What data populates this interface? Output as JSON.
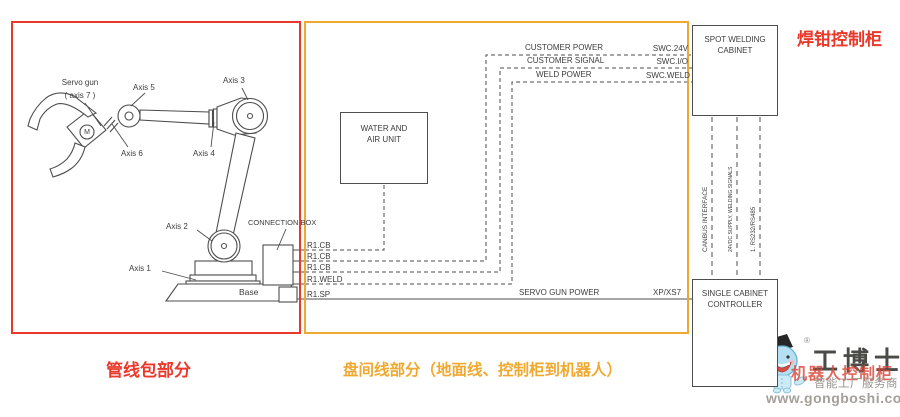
{
  "colors": {
    "region_red": "#e8392b",
    "region_orange": "#f0a930",
    "line_gray": "#4d4d4d",
    "text_gray": "#3c3c3c"
  },
  "regions": {
    "dress_pack_label": "管线包部分",
    "interconnect_label": "盘间线部分（地面线、控制柜到机器人）",
    "weld_cabinet_label": "焊钳控制柜"
  },
  "robot": {
    "servo_gun_line1": "Servo gun",
    "servo_gun_line2": "( axis 7 )",
    "axis1": "Axis 1",
    "axis2": "Axis 2",
    "axis3": "Axis 3",
    "axis4": "Axis 4",
    "axis5": "Axis 5",
    "axis6": "Axis 6",
    "motor": "M",
    "base": "Base",
    "connection_box": "CONNECTION BOX"
  },
  "units": {
    "water_air_line1": "WATER AND",
    "water_air_line2": "AIR UNIT",
    "spot_welding_line1": "SPOT WELDING",
    "spot_welding_line2": "CABINET",
    "controller_line1": "SINGLE CABINET",
    "controller_line2": "CONTROLLER"
  },
  "wires": {
    "r1cb_1": "R1.CB",
    "r1cb_2": "R1.CB",
    "r1cb_3": "R1.CB",
    "r1weld": "R1.WELD",
    "r1sp": "R1.SP",
    "customer_power": "CUSTOMER POWER",
    "swc_24v": "SWC.24V",
    "customer_signal": "CUSTOMER SIGNAL",
    "swc_io": "SWC.I/O",
    "weld_power": "WELD POWER",
    "swc_weld": "SWC.WELD",
    "servo_gun_power": "SERVO GUN POWER",
    "xp_xs7": "XP/XS7",
    "canbus": "CANBUS INTERFACE",
    "supply_weld_signals": "24VDC SUPPLY, WELDING SIGNALS",
    "rs232": "1. RS232/RS485"
  },
  "watermark": {
    "registered": "®",
    "brand": "工博士",
    "overlay": "机器人控制柜",
    "tagline": "智能工厂服务商",
    "url": "www.gongboshi.com"
  }
}
